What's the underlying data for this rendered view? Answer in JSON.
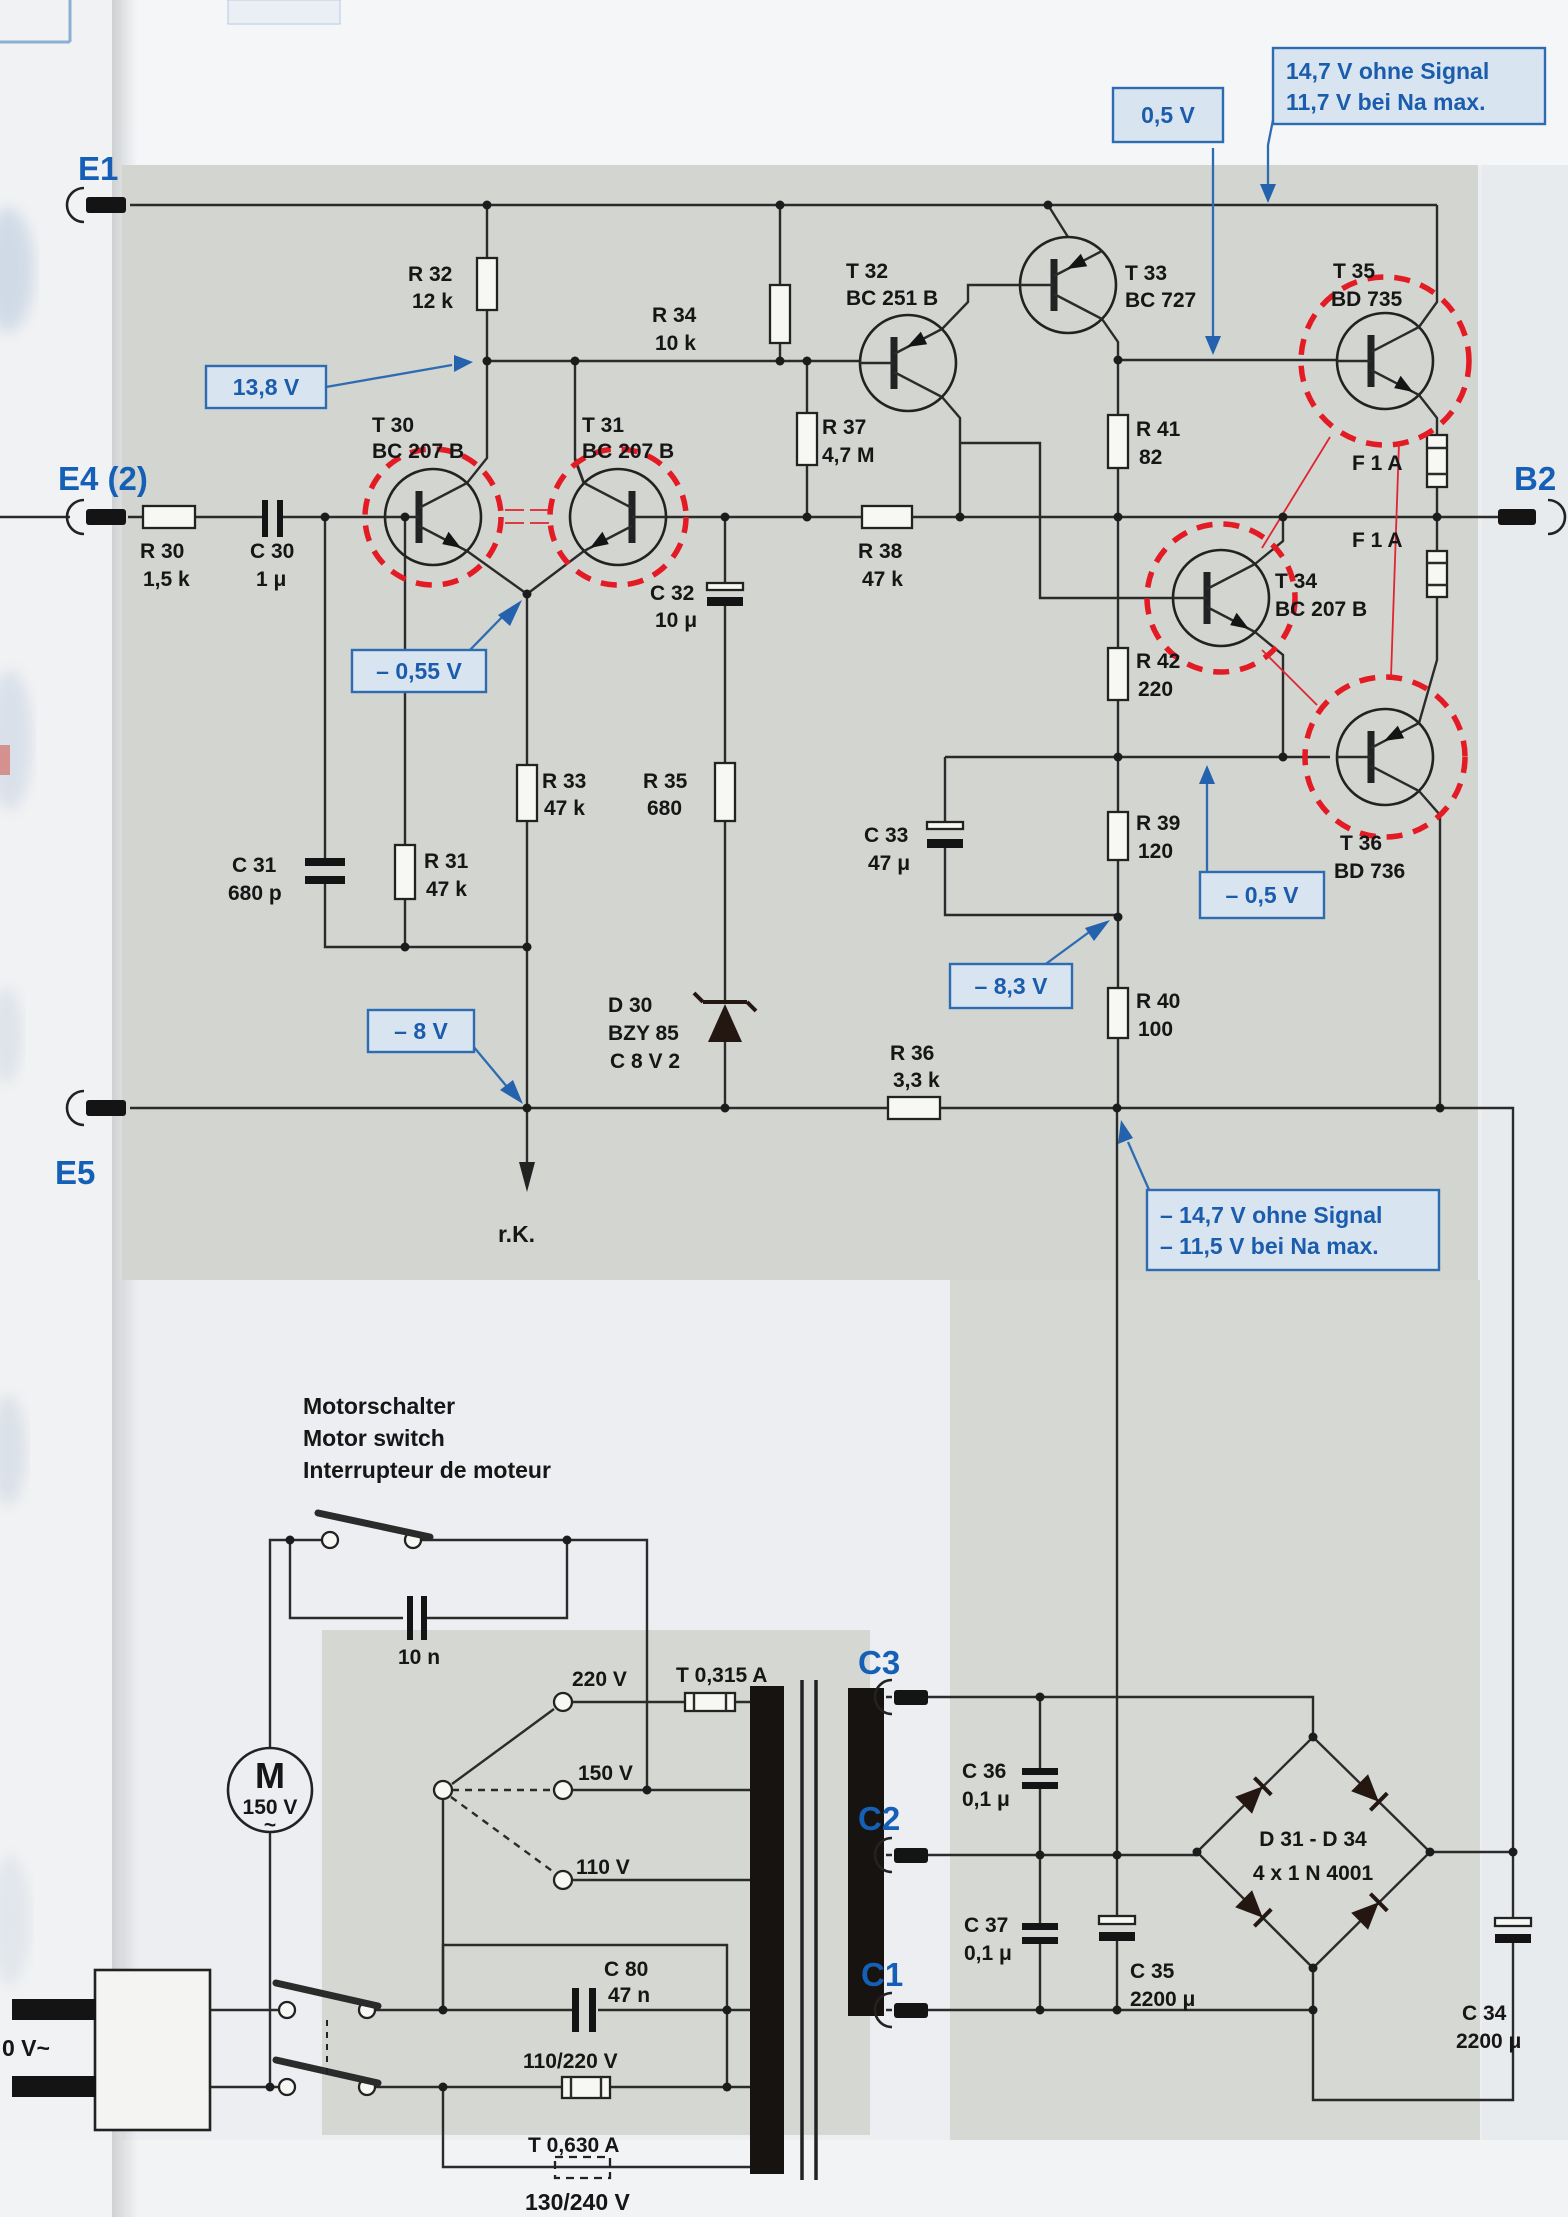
{
  "amp": {
    "e1": "E1",
    "e4": "E4 (2)",
    "e5": "E5",
    "b2": "B2",
    "c_top1": "14,7 V ohne Signal",
    "c_top2": "11,7 V bei Na max.",
    "c_half": "0,5 V",
    "c_138": "13,8 V",
    "c_m055": "– 0,55 V",
    "c_m8": "– 8 V",
    "c_m83": "– 8,3 V",
    "c_m05": "– 0,5 V",
    "c_bot1": "– 14,7 V ohne Signal",
    "c_bot2": "– 11,5 V bei Na max.",
    "t30r": "T 30",
    "t30p": "BC 207 B",
    "t31r": "T 31",
    "t31p": "BC 207 B",
    "t32r": "T 32",
    "t32p": "BC 251 B",
    "t33r": "T 33",
    "t33p": "BC 727",
    "t34r": "T 34",
    "t34p": "BC 207 B",
    "t35r": "T 35",
    "t35p": "BD 735",
    "t36r": "T 36",
    "t36p": "BD 736",
    "r30r": "R 30",
    "r30v": "1,5 k",
    "r31r": "R 31",
    "r31v": "47 k",
    "r32r": "R 32",
    "r32v": "12 k",
    "r33r": "R 33",
    "r33v": "47 k",
    "r34r": "R 34",
    "r34v": "10 k",
    "r35r": "R 35",
    "r35v": "680",
    "r36r": "R 36",
    "r36v": "3,3 k",
    "r37r": "R 37",
    "r37v": "4,7 M",
    "r38r": "R 38",
    "r38v": "47 k",
    "r39r": "R 39",
    "r39v": "120",
    "r40r": "R 40",
    "r40v": "100",
    "r41r": "R 41",
    "r41v": "82",
    "r42r": "R 42",
    "r42v": "220",
    "c30r": "C 30",
    "c30v": "1 μ",
    "c31r": "C 31",
    "c31v": "680 p",
    "c32r": "C 32",
    "c32v": "10 μ",
    "c33r": "C 33",
    "c33v": "47 μ",
    "d30r": "D 30",
    "d30p": "BZY 85",
    "d30v": "C 8 V 2",
    "fu1": "F 1 A",
    "fu2": "F 1 A",
    "rk": "r.K."
  },
  "psu": {
    "sw1": "Motorschalter",
    "sw2": "Motor switch",
    "sw3": "Interrupteur de moteur",
    "sn": "10 n",
    "mm": "M",
    "mv": "150 V",
    "mac": "~",
    "t220": "220 V",
    "t150": "150 V",
    "t110": "110 V",
    "f315": "T 0,315 A",
    "f630": "T 0,630 A",
    "f110": "110/220 V",
    "v130": "130/240 V",
    "c80r": "C 80",
    "c80v": "47 n",
    "c1": "C1",
    "c2": "C2",
    "c3": "C3",
    "c34r": "C 34",
    "c34v": "2200 μ",
    "c35r": "C 35",
    "c35v": "2200 μ",
    "c36r": "C 36",
    "c36v": "0,1 μ",
    "c37r": "C 37",
    "c37v": "0,1 μ",
    "br1": "D 31 - D 34",
    "br2": "4 x 1 N 4001",
    "mains": "0 V~"
  }
}
